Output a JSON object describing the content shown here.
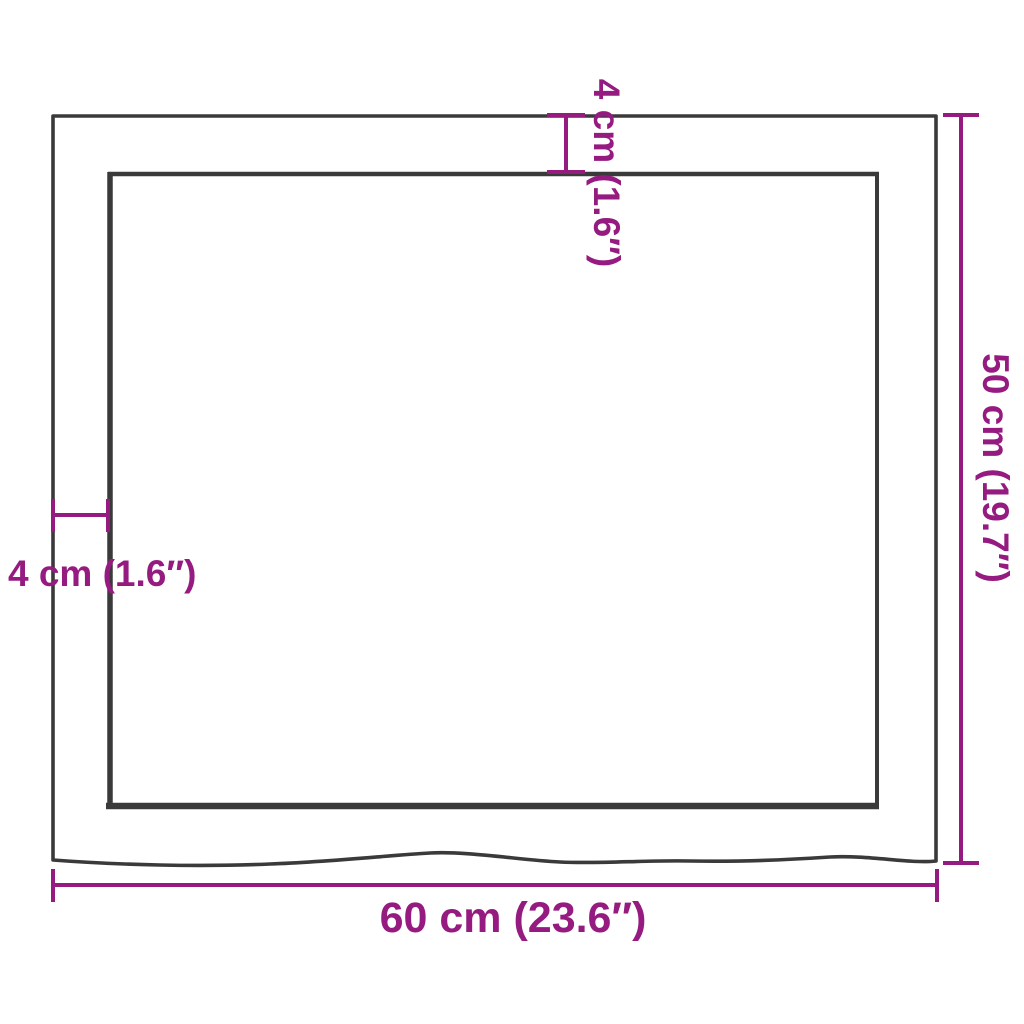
{
  "diagram": {
    "type": "product-dimension-diagram",
    "subject": "tabletop top view with live wavy front edge",
    "colors": {
      "dimension_accent": "#951B81",
      "outline": "#3A3A3A",
      "background": "#FFFFFF"
    },
    "labels": {
      "width_bottom": "60 cm (23.6″)",
      "height_right": "50 cm (19.7″)",
      "edge_top": "4 cm (1.6″)",
      "edge_left": "4 cm (1.6″)"
    },
    "measurements": [
      {
        "name": "width",
        "cm": 60,
        "inches": 23.6,
        "label": "60 cm (23.6″)",
        "position": "bottom",
        "orientation": "horizontal"
      },
      {
        "name": "depth",
        "cm": 50,
        "inches": 19.7,
        "label": "50 cm (19.7″)",
        "position": "right",
        "orientation": "vertical-rotated"
      },
      {
        "name": "edge-thickness-top",
        "cm": 4,
        "inches": 1.6,
        "label": "4 cm (1.6″)",
        "position": "top",
        "orientation": "vertical-rotated"
      },
      {
        "name": "edge-thickness-left",
        "cm": 4,
        "inches": 1.6,
        "label": "4 cm (1.6″)",
        "position": "left",
        "orientation": "horizontal"
      }
    ]
  }
}
